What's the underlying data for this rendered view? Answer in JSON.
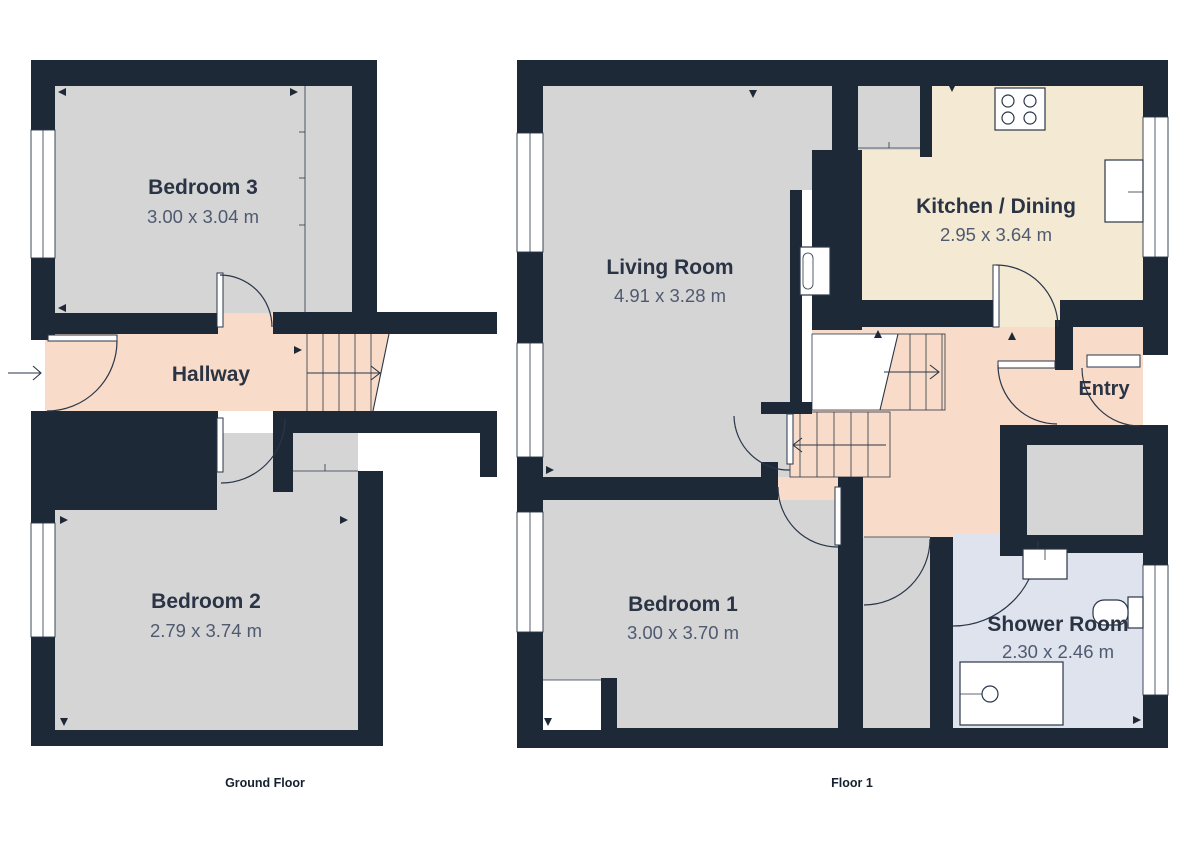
{
  "colors": {
    "bg": "#ffffff",
    "wall": "#1e2938",
    "line": "#2a3648",
    "floor_gray": "#d5d5d6",
    "floor_pink": "#f8dbc8",
    "floor_cream": "#f4ead3",
    "floor_blue": "#dfe3ee",
    "ink": "#2b3444",
    "dim_text": "#4f5a70"
  },
  "ground_floor": {
    "caption": "Ground Floor",
    "rooms": {
      "bedroom3": {
        "name": "Bedroom 3",
        "dims": "3.00 x 3.04 m"
      },
      "hallway": {
        "name": "Hallway"
      },
      "bedroom2": {
        "name": "Bedroom 2",
        "dims": "2.79 x 3.74 m"
      }
    }
  },
  "floor1": {
    "caption": "Floor 1",
    "rooms": {
      "living": {
        "name": "Living Room",
        "dims": "4.91 x 3.28 m"
      },
      "kitchen": {
        "name": "Kitchen / Dining",
        "dims": "2.95 x 3.64 m"
      },
      "entry": {
        "name": "Entry"
      },
      "bedroom1": {
        "name": "Bedroom 1",
        "dims": "3.00 x 3.70 m"
      },
      "shower": {
        "name": "Shower Room",
        "dims": "2.30 x 2.46 m"
      }
    }
  }
}
